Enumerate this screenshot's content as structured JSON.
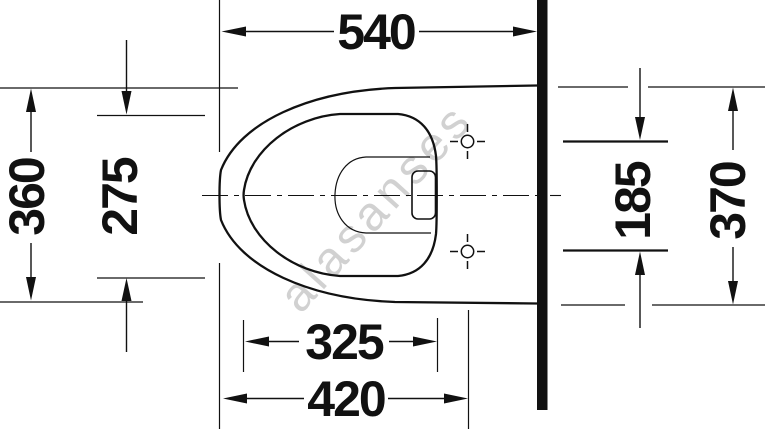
{
  "drawing": {
    "title": "wall-hung-toilet-top-view-dimension-drawing",
    "dimensions": {
      "top_width": "540",
      "left_outer": "360",
      "left_inner": "275",
      "right_holes": "185",
      "right_outer": "370",
      "bottom_inner": "325",
      "bottom_outer": "420"
    },
    "watermark": "alasanses",
    "colors": {
      "line": "#111111",
      "watermark": "#c9c9c9",
      "background": "#ffffff"
    }
  }
}
